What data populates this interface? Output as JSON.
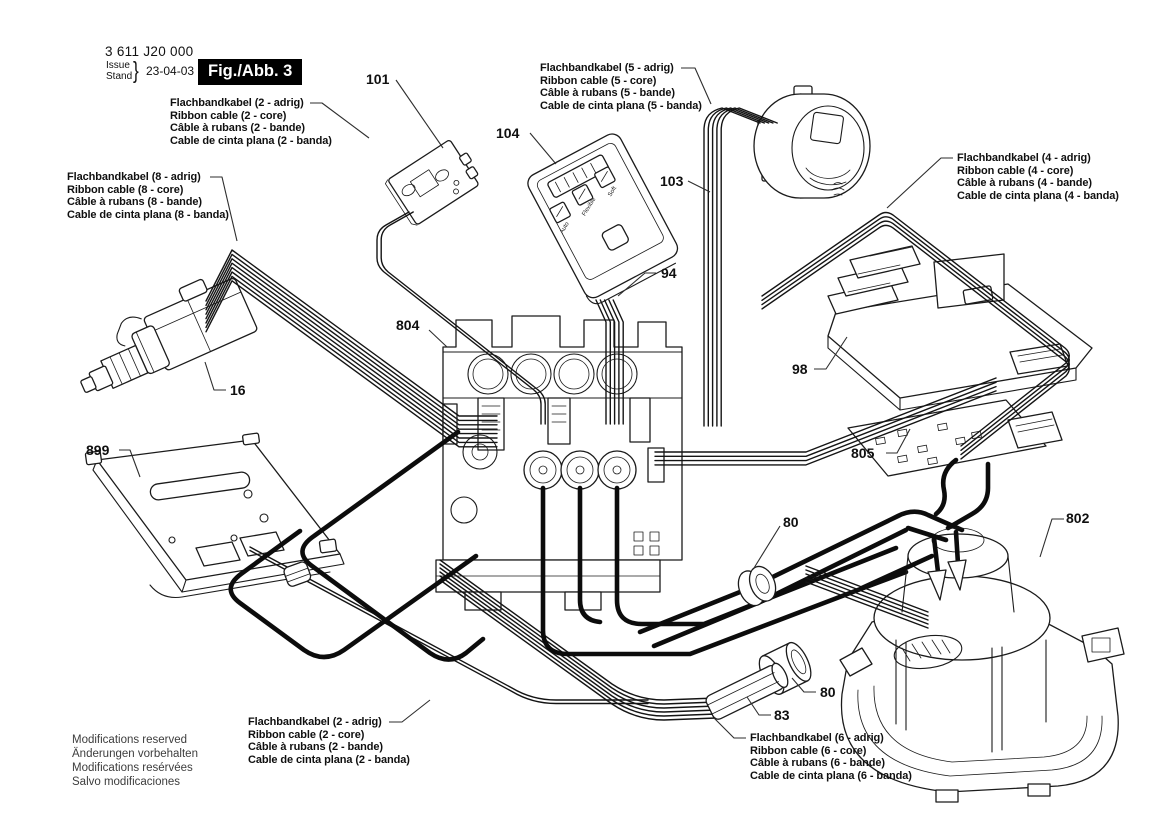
{
  "header": {
    "type_number": "3 611 J20 000",
    "issue_label": "Issue",
    "stand_label": "Stand",
    "brace": "}",
    "date": "23-04-03",
    "figure_label": "Fig./Abb. 3"
  },
  "cable_labels": {
    "ribbon_2core_top": {
      "de": "Flachbandkabel (2 - adrig)",
      "en": "Ribbon cable (2 - core)",
      "fr": "Câble à rubans (2 - bande)",
      "es": "Cable de cinta plana (2 - banda)"
    },
    "ribbon_8core_left": {
      "de": "Flachbandkabel (8 - adrig)",
      "en": "Ribbon cable (8 - core)",
      "fr": "Câble à rubans (8 - bande)",
      "es": "Cable de cinta plana (8 - banda)"
    },
    "ribbon_5core_top": {
      "de": "Flachbandkabel (5 - adrig)",
      "en": "Ribbon cable (5 - core)",
      "fr": "Câble à rubans (5 - bande)",
      "es": "Cable de cinta plana (5 - banda)"
    },
    "ribbon_4core_right": {
      "de": "Flachbandkabel (4 - adrig)",
      "en": "Ribbon cable (4 - core)",
      "fr": "Câble à rubans (4 - bande)",
      "es": "Cable de cinta plana (4 - banda)"
    },
    "ribbon_2core_bottom": {
      "de": "Flachbandkabel (2 - adrig)",
      "en": "Ribbon cable (2 - core)",
      "fr": "Câble à rubans (2 - bande)",
      "es": "Cable de cinta plana (2 - banda)"
    },
    "ribbon_6core_bottom": {
      "de": "Flachbandkabel (6 - adrig)",
      "en": "Ribbon cable (6 - core)",
      "fr": "Câble à rubans (6 - bande)",
      "es": "Cable de cinta plana (6 - banda)"
    }
  },
  "part_numbers": {
    "p101": "101",
    "p104": "104",
    "p103": "103",
    "p94": "94",
    "p804": "804",
    "p98": "98",
    "p805": "805",
    "p16": "16",
    "p899": "899",
    "p80a": "80",
    "p802": "802",
    "p80b": "80",
    "p83": "83"
  },
  "panel_buttons": {
    "b1": "Auto",
    "b2": "Flexible",
    "b3": "Soft"
  },
  "footer": {
    "en": "Modifications reserved",
    "de": "Änderungen vorbehalten",
    "fr": "Modifications resérvées",
    "es": "Salvo modificaciones"
  },
  "colors": {
    "line": "#1b1b1b",
    "figure_box_bg": "#000000",
    "figure_box_text": "#ffffff",
    "background": "#ffffff"
  }
}
